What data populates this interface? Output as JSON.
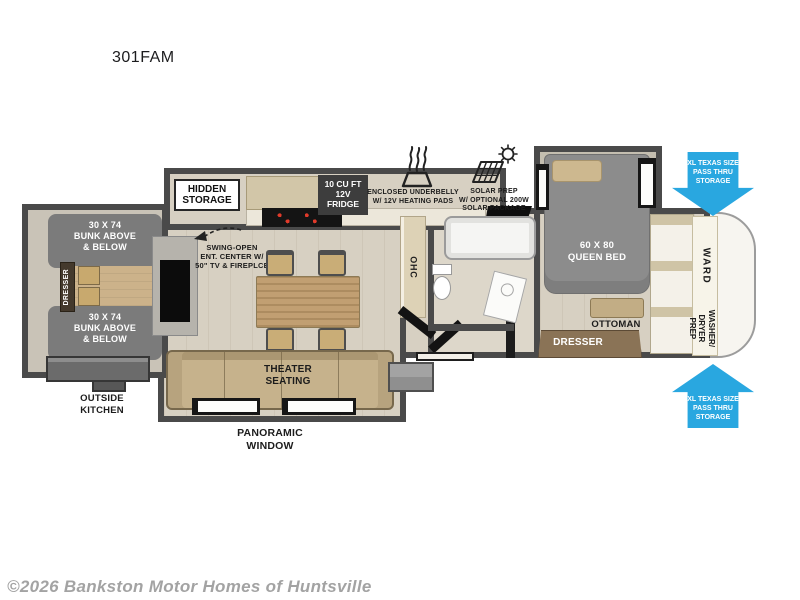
{
  "title": "301FAM",
  "watermark": "©2026 Bankston Motor Homes of Huntsville",
  "colors": {
    "wall": "#4a4a4a",
    "floor": "#d7d0c2",
    "accent_blue": "#29a7e0",
    "bed_gray": "#8c8c8c",
    "sofa_tan": "#c6b28c",
    "wood_tan": "#c19f72",
    "dresser_brown": "#8a7356",
    "dark_label_bg": "#3d3d3d"
  },
  "rooms": {
    "hidden_storage": "HIDDEN\nSTORAGE",
    "fridge": "10 CU FT\n12V\nFRIDGE",
    "underbelly": "ENCLOSED UNDERBELLY\nW/ 12V HEATING PADS",
    "solar": "SOLAR PREP\nW/ OPTIONAL 200W\nSOLAR PACKAGE",
    "queen_bed": "60 X 80\nQUEEN BED",
    "pass_thru": "XL TEXAS SIZE\nPASS THRU\nSTORAGE",
    "bunk": "30 X 74\nBUNK ABOVE\n& BELOW",
    "dresser": "DRESSER",
    "outside_kitchen": "OUTSIDE\nKITCHEN",
    "ent_center": "SWING-OPEN\nENT. CENTER W/\n50\" TV & FIREPLCE",
    "ohc": "OHC",
    "theater": "THEATER\nSEATING",
    "panoramic": "PANORAMIC\nWINDOW",
    "ottoman": "OTTOMAN",
    "ward": "WARD",
    "washer": "WASHER/\nDRYER\nPREP"
  }
}
